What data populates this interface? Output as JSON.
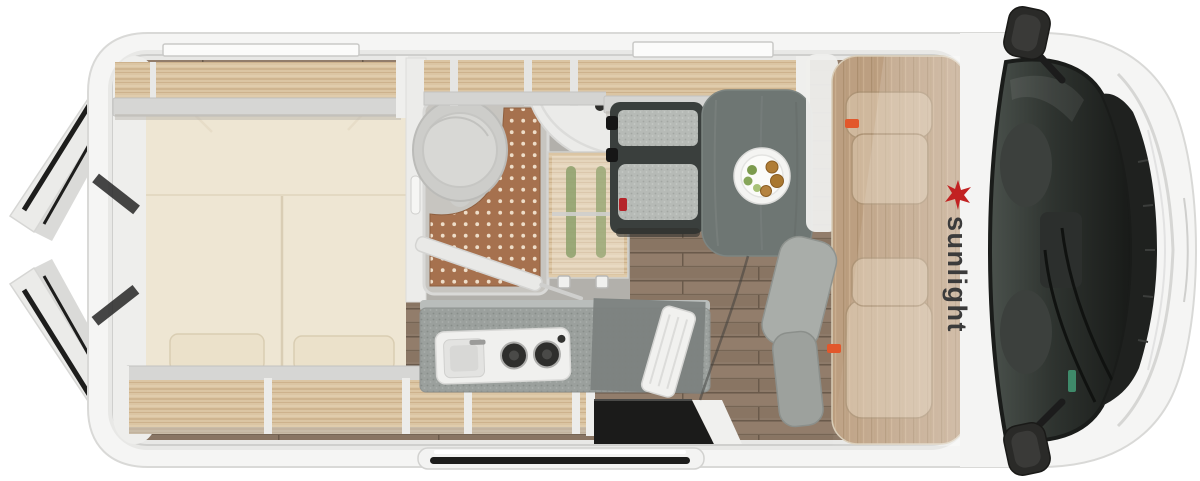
{
  "brand": {
    "logo_text": "sunlight",
    "logo_text_color": "#3b3b3b",
    "logo_sun_color": "#c22222"
  },
  "palette": {
    "background": "#ffffff",
    "body_white": "#f5f5f4",
    "wall_gray": "#e8e8e6",
    "wood_light": "#dbc5a3",
    "bed_cream": "#eee6d3",
    "pillow_cream": "#ebe1ca",
    "shower_mat_terracotta": "#a6714e",
    "bathroom_floor_gray": "#b2b0ab",
    "living_floor_wood": "#8d7a69",
    "cab_floor_wood": "#bc9f81",
    "counter_gray": "#9ba09d",
    "table_gray": "#6e7673",
    "bench_frame_dark": "#3a3f3d",
    "cushion_speckle": "#b6bab6",
    "windshield_glass": "#2e332f",
    "door_seal_black": "#1d1d1c",
    "buckle_red": "#b5242a",
    "tag_orange": "#e2572b",
    "bottle_green": "#8da06b",
    "food_green": "#7c9b4e",
    "food_brown": "#a9772f"
  },
  "floorplan": {
    "view": "camper-van-top-down-floorplan",
    "areas": [
      "rear-bed-transverse",
      "bathroom-with-shower-toilet-sink",
      "wardrobe-cupboard",
      "kitchen-with-sink-and-2-burner-stove",
      "dinette-bench-and-table",
      "cab-with-two-swivel-seats"
    ],
    "details": {
      "stove_burners": 2,
      "pillows": 2,
      "rear_doors_open": 2,
      "sliding_door_open": true,
      "plate_of_food_on_table": true,
      "roof_vents": 2
    }
  }
}
